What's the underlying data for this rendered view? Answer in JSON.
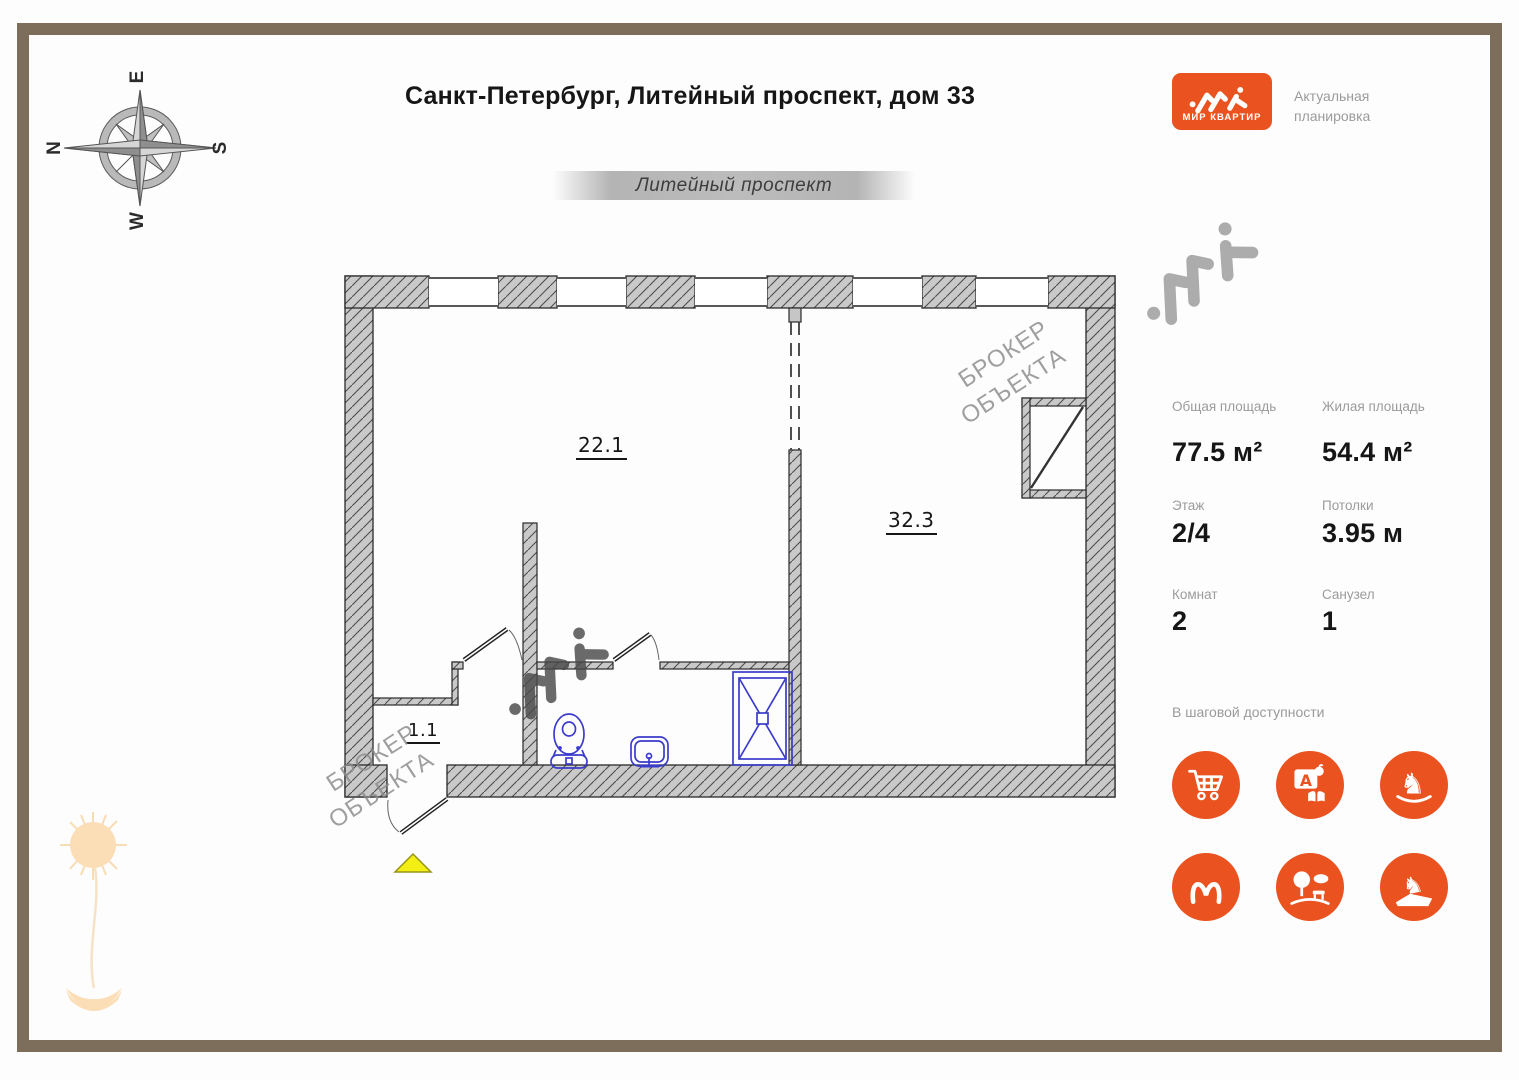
{
  "title": "Санкт-Петербург, Литейный проспект, дом 33",
  "logo": {
    "name": "МИР КВАРТИР",
    "tagline_1": "Актуальная",
    "tagline_2": "планировка"
  },
  "street_banner": "Литейный проспект",
  "compass": {
    "top": "E",
    "left": "N",
    "right": "S",
    "bottom": "W"
  },
  "plan": {
    "room_main_area": "22.1",
    "room_second_area": "32.3",
    "hallway_area": "1.1"
  },
  "watermark": {
    "line_1": "БРОКЕР",
    "line_2": "ОБЪЕКТА"
  },
  "stats": {
    "total_area_label": "Общая площадь",
    "total_area_value": "77.5 м²",
    "living_area_label": "Жилая площадь",
    "living_area_value": "54.4 м²",
    "floor_label": "Этаж",
    "floor_value": "2/4",
    "ceiling_label": "Потолки",
    "ceiling_value": "3.95 м",
    "rooms_label": "Комнат",
    "rooms_value": "2",
    "bathroom_label": "Санузел",
    "bathroom_value": "1"
  },
  "amenities": {
    "title": "В шаговой доступности",
    "icons": [
      "shopping-cart-icon",
      "school-icon",
      "rocking-horse-icon",
      "metro-icon",
      "park-icon",
      "monument-icon"
    ]
  },
  "colors": {
    "accent_orange": "#EA5320",
    "frame_brown": "#7D6E5B",
    "fixture_blue": "#3B3BCC",
    "wall_gray": "#C9C9C9"
  }
}
